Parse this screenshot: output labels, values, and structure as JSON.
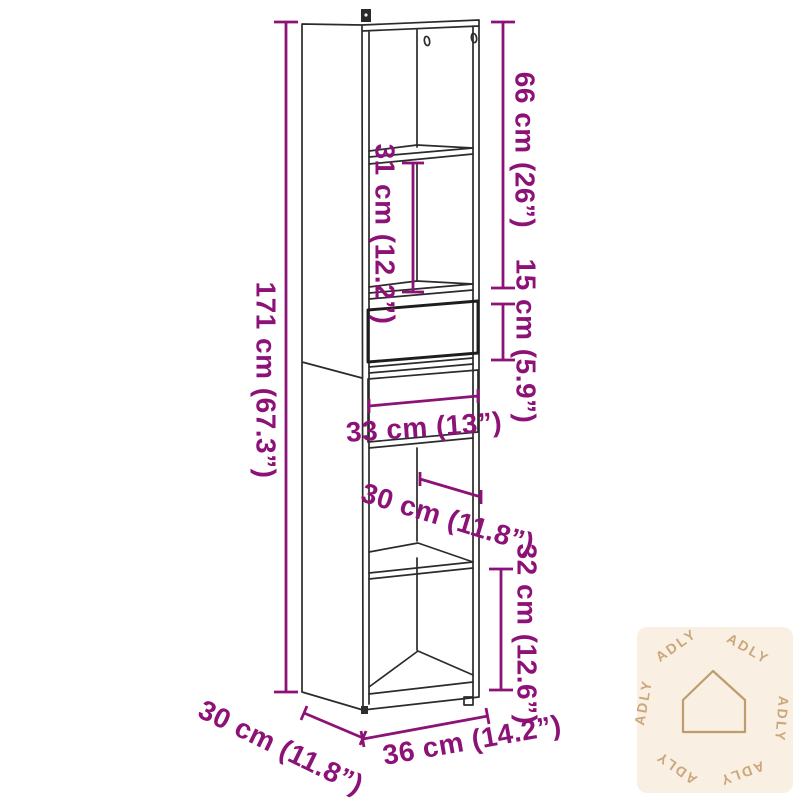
{
  "diagram": {
    "type": "furniture-dimension-diagram",
    "product": "tall-highboard-cabinet-line-drawing",
    "colors": {
      "dimension_accent": "#8c1277",
      "drawing_line": "#2b2b2b",
      "watermark_bg": "#f9efe2",
      "watermark_fg": "#c6a172",
      "background": "#ffffff"
    },
    "labels": {
      "total_height": "171 cm (67.3”)",
      "upper_section_height": "66 cm (26”)",
      "middle_shelf_height": "31 cm (12.2”)",
      "drawer_height": "15 cm (5.9”)",
      "inner_width": "33 cm (13”)",
      "inner_depth": "30 cm (11.8”)",
      "lower_compartment_height": "32 cm (12.6”)",
      "outer_depth": "30 cm (11.8”)",
      "outer_width": "36 cm (14.2”)"
    },
    "watermark": {
      "brand": "ADLY",
      "logo": "house-icon",
      "brand_repetitions": 6
    }
  }
}
